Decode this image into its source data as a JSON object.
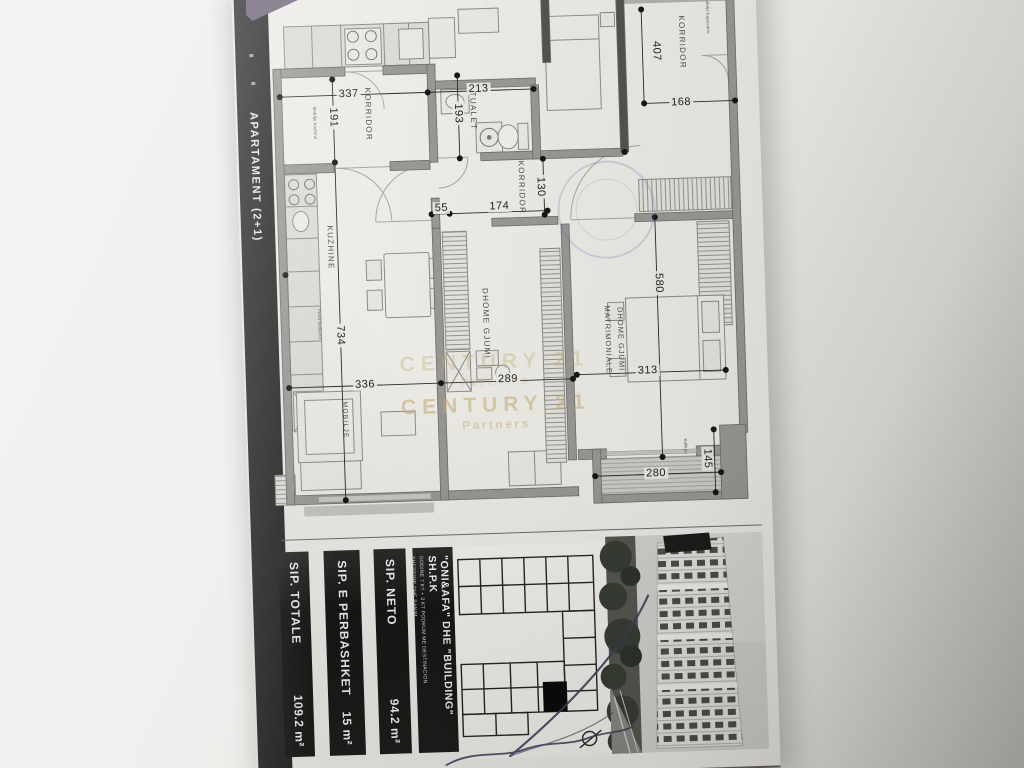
{
  "document": {
    "strip": {
      "label": "APARTAMENT (2+1)"
    },
    "plan": {
      "dims": {
        "d337": "337",
        "d213": "213",
        "d168": "168",
        "d55": "55",
        "d174": "174",
        "d336": "336",
        "d289": "289",
        "d313": "313",
        "d280": "280",
        "d191": "191",
        "d193": "193",
        "d407": "407",
        "d130": "130",
        "d734": "734",
        "d580": "580",
        "d145": "145"
      },
      "rooms": {
        "korridor1": "KORRIDOR",
        "korridor2": "KORRIDOR",
        "korridor3": "KORRIDOR",
        "tualet": "TUALET",
        "kuzhine": "KUZHINE",
        "dhome_gjumi": "DHOME GJUMI",
        "matrimoniale_line1": "DHOME GJUMI",
        "matrimoniale_line2": "MATRIMONIALE",
        "mobilje": "MOBILJE"
      },
      "notes": {
        "kitchen": "Mobilje kuzhine",
        "balcony_door": "Porta ballkonit",
        "corridor": "Mobilje kapuciere",
        "balcony": "Ballkon"
      },
      "watermark": {
        "line1": "CENTURY 21",
        "line2": "Partners"
      }
    },
    "title_block": {
      "company": {
        "name": "\"ONI&AFA\" DHE \"BUILDING\" SH.P.K",
        "subtitle1": "GODINE 7 KT + 3 KT PODRUM ME DESTINACION",
        "subtitle2": "SHERBIME DHE BANIM"
      },
      "rows": {
        "totale": {
          "label": "SIP. TOTALE",
          "value": "109.2 m²"
        },
        "perbashket": {
          "label": "SIP. E PERBASHKET",
          "value": "15 m²"
        },
        "neto": {
          "label": "SIP. NETO",
          "value": "94.2 m²"
        }
      }
    }
  }
}
